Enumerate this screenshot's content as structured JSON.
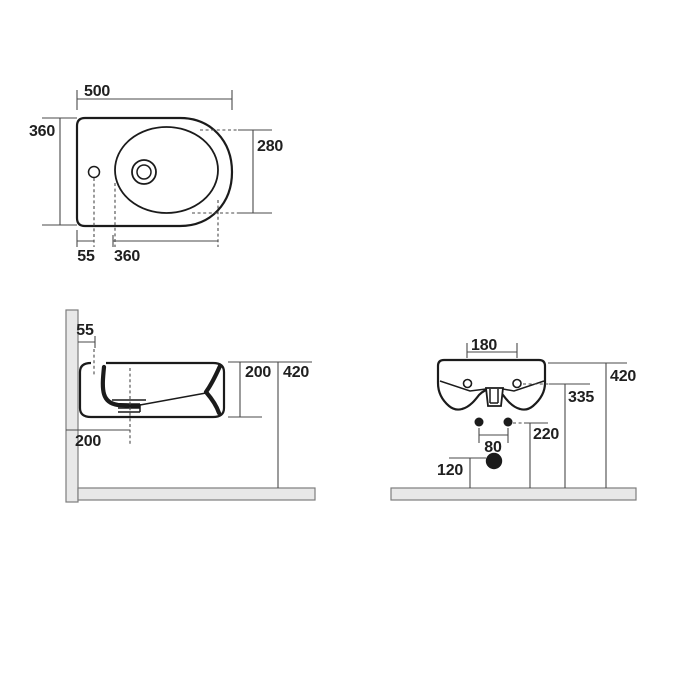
{
  "drawing": {
    "type": "wall-hung bidet installation drawing",
    "views": [
      "plan",
      "side",
      "rear"
    ]
  },
  "plan": {
    "width": "500",
    "depth": "360",
    "basin_depth": "280",
    "tap_offset": "55",
    "basin_length": "360"
  },
  "side": {
    "tap_offset": "55",
    "body_depth": "200",
    "rim_height": "420",
    "drain_offset": "200"
  },
  "rear": {
    "hole_spacing": "180",
    "rim_height": "420",
    "mount_height": "335",
    "bolt_height": "220",
    "bolt_spacing": "80",
    "drain_height": "120"
  },
  "colors": {
    "line": "#1b1b1b",
    "dim": "#4a4a4a",
    "text": "#1f1f1f",
    "slab": "#e8e8e8",
    "slabStroke": "#7d7d7d",
    "background": "#ffffff"
  }
}
